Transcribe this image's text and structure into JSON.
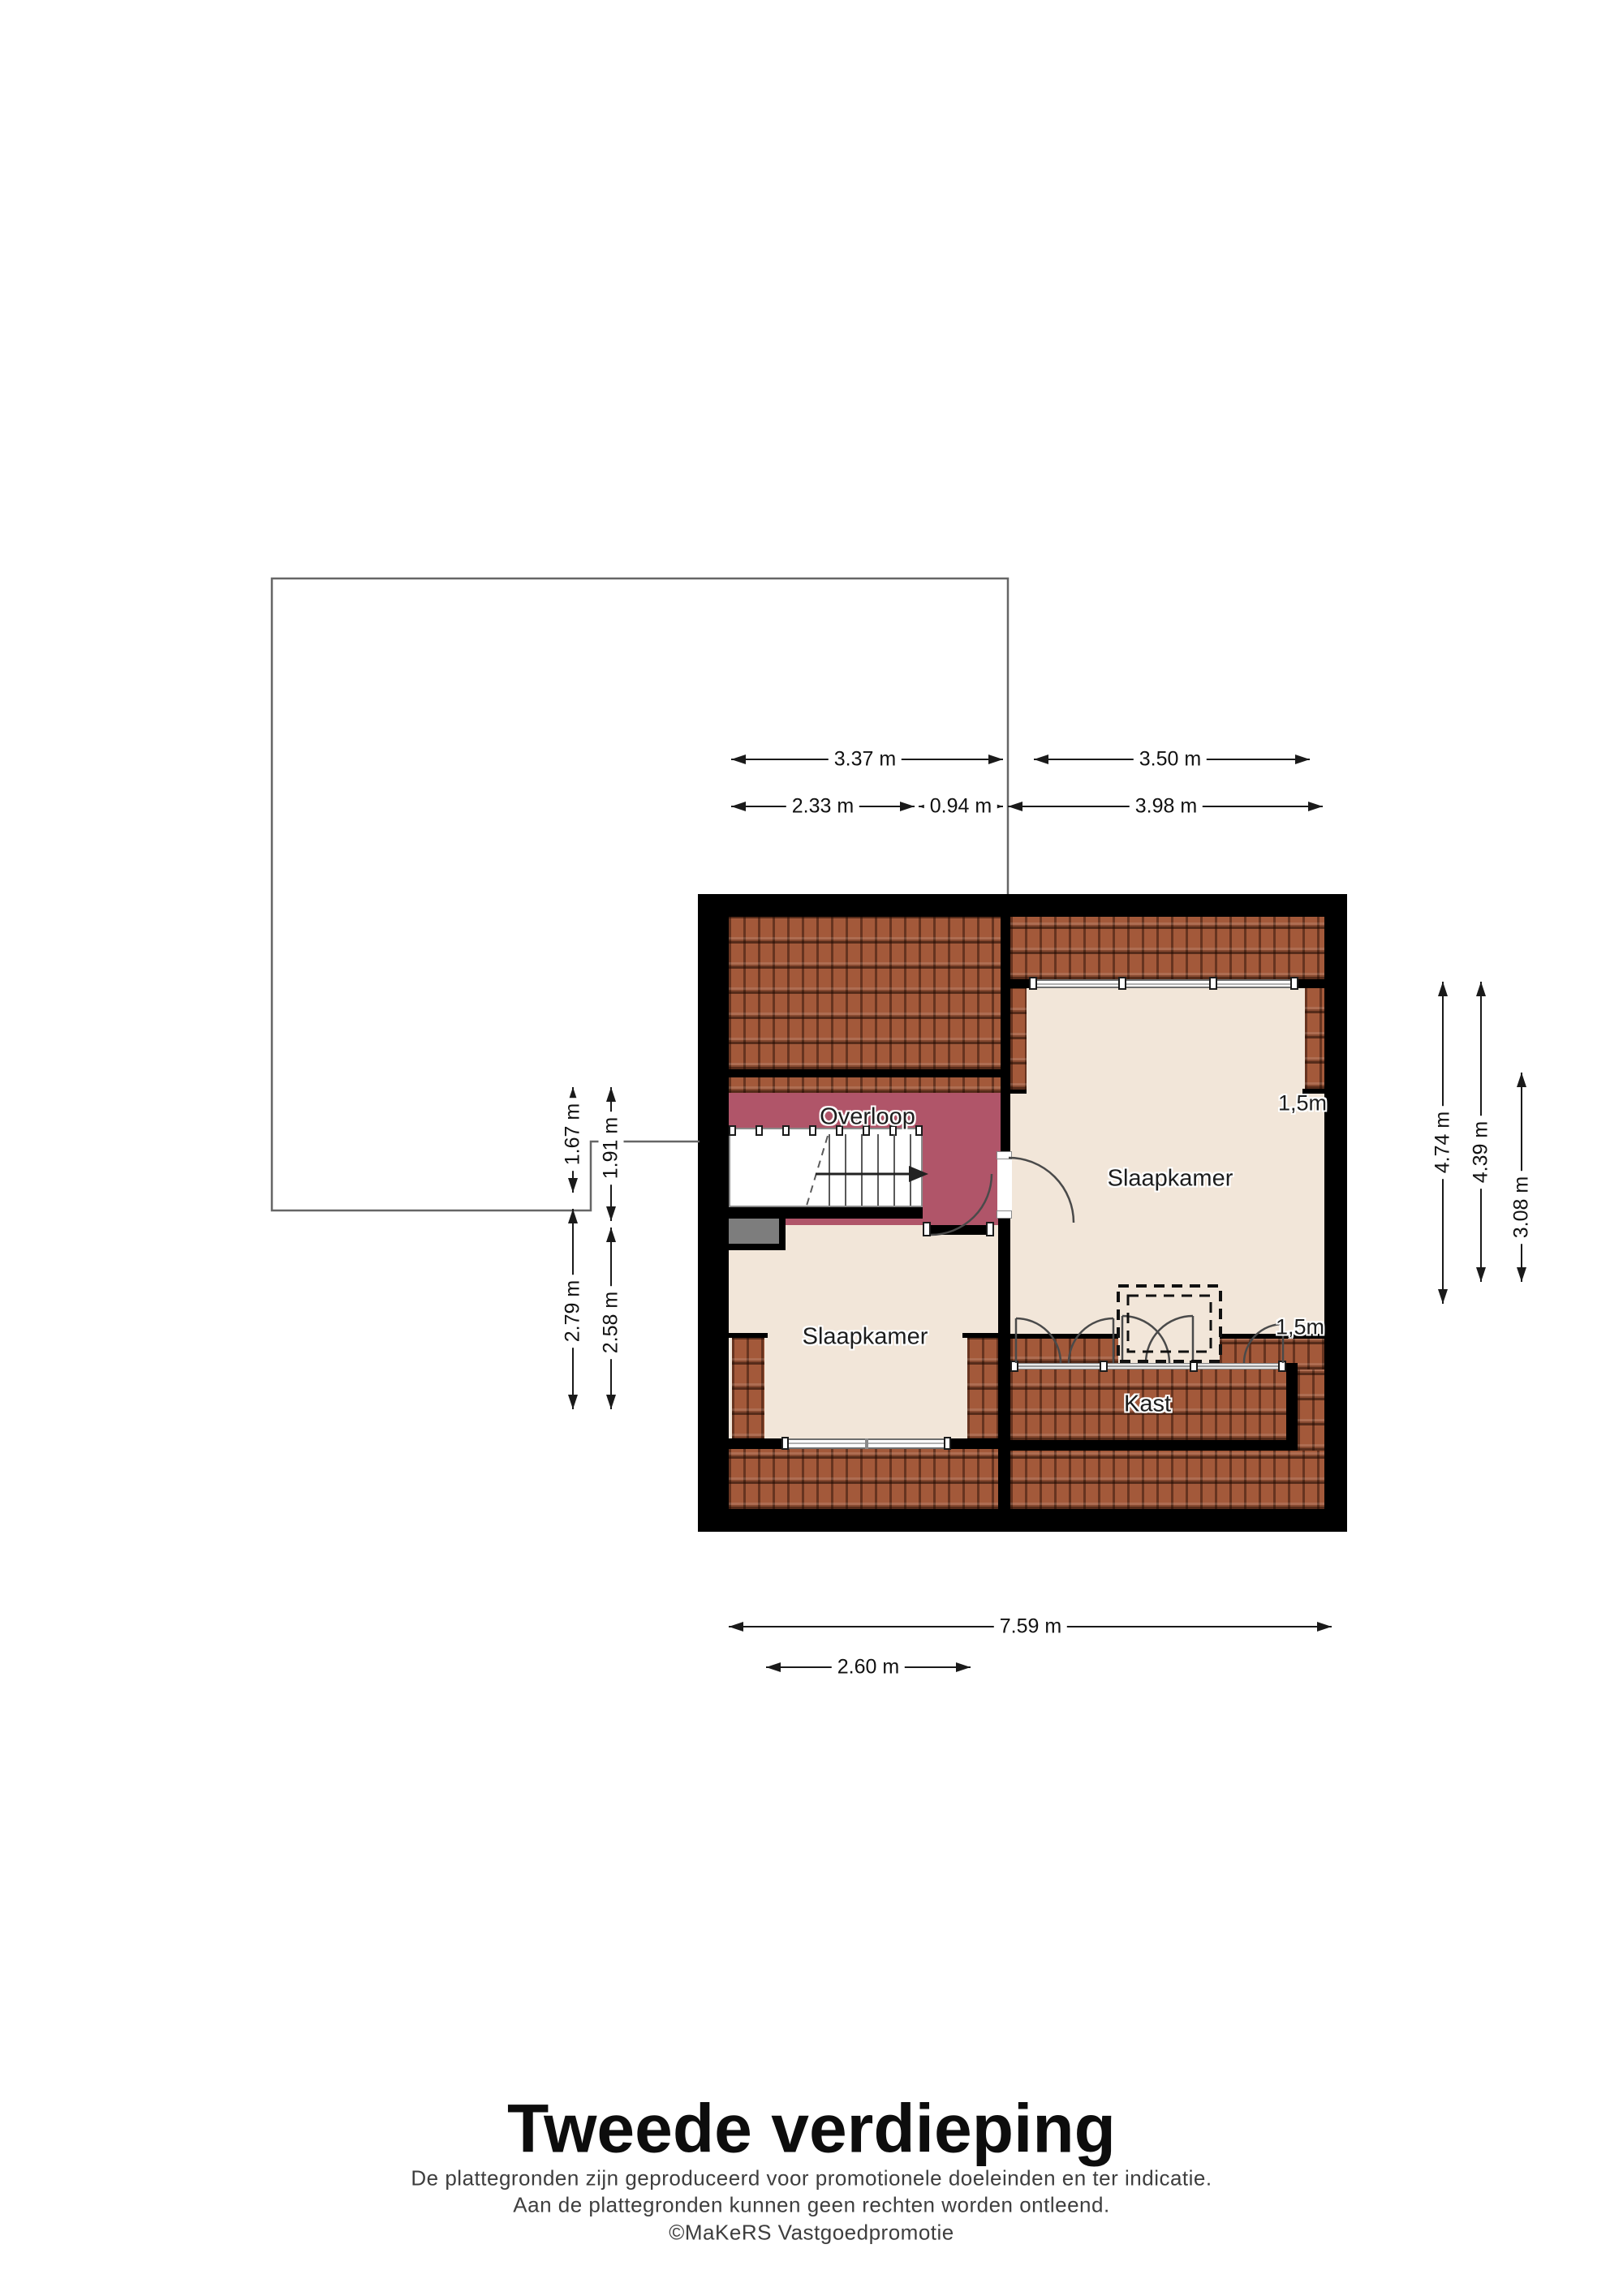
{
  "page": {
    "title": "Tweede verdieping"
  },
  "disclaimer": {
    "line1": "De plattegronden zijn geproduceerd voor promotionele doeleinden en ter indicatie.",
    "line2": "Aan de plattegronden kunnen geen rechten worden ontleend.",
    "line3": "©MaKeRS Vastgoedpromotie"
  },
  "rooms": {
    "overloop": "Overloop",
    "slaapkamer_right": "Slaapkamer",
    "slaapkamer_left": "Slaapkamer",
    "kast": "Kast"
  },
  "headroom": {
    "right_bedroom": "1,5m",
    "kast_side": "1,5m"
  },
  "dimensions": {
    "top_row1": [
      {
        "label": "3.37 m"
      },
      {
        "label": "3.50 m"
      }
    ],
    "top_row2": [
      {
        "label": "2.33 m"
      },
      {
        "label": "0.94 m"
      },
      {
        "label": "3.98 m"
      }
    ],
    "left": [
      {
        "label": "1.67 m"
      },
      {
        "label": "1.91 m"
      },
      {
        "label": "2.79 m"
      },
      {
        "label": "2.58 m"
      }
    ],
    "right": [
      {
        "label": "4.74 m"
      },
      {
        "label": "4.39 m"
      },
      {
        "label": "3.08 m"
      }
    ],
    "bottom": [
      {
        "label": "7.59 m"
      },
      {
        "label": "2.60 m"
      }
    ]
  },
  "colors": {
    "wall": "#000000",
    "floor": "#f2e6d9",
    "hallway": "#b05569",
    "roof_tiles": "#a3593a",
    "chimney": "#7d7d7d",
    "dimension_line": "#1a1a1a"
  }
}
